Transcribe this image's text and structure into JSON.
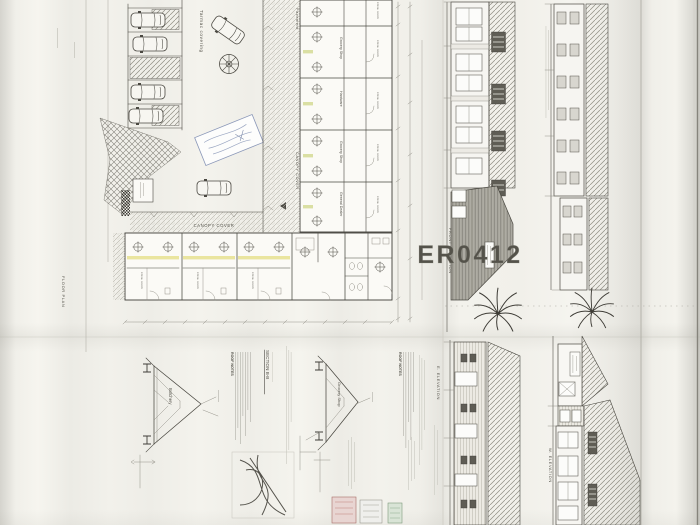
{
  "watermark_text": "ER0412",
  "colors": {
    "paper": "#efeee8",
    "ink": "#4a4841",
    "hatch": "#8f8d83",
    "highlight_yellow": "#e3dc7a",
    "stamp_blue": "#8a97b8",
    "detail_red": "#c1837b",
    "detail_green": "#8fae8c",
    "watermark": "#ffffff"
  },
  "site_plan": {
    "title": "FLOOR PLAN",
    "tarmac_label": "Tarmac covering",
    "pavement_label": "Pavement",
    "canopy_label_vertical": "CANOPY COVER",
    "canopy_label_horizontal": "CANOPY COVER",
    "store_label": "store room",
    "shops_east_wing": [
      {
        "name": "Grocery Shop"
      },
      {
        "name": "Hardware"
      },
      {
        "name": "Grocery Shop"
      },
      {
        "name": "General Dealer"
      }
    ]
  },
  "elevations": {
    "front": "FRONT ELEVATION",
    "east": "E. ELEVATION",
    "west": "W. ELEVATION"
  },
  "sections": {
    "b_b": {
      "title": "SECTION B-B",
      "room": "Butchery"
    },
    "b": {
      "room": "Grocery Shop"
    },
    "roof_notes_title": "ROOF NOTES"
  }
}
